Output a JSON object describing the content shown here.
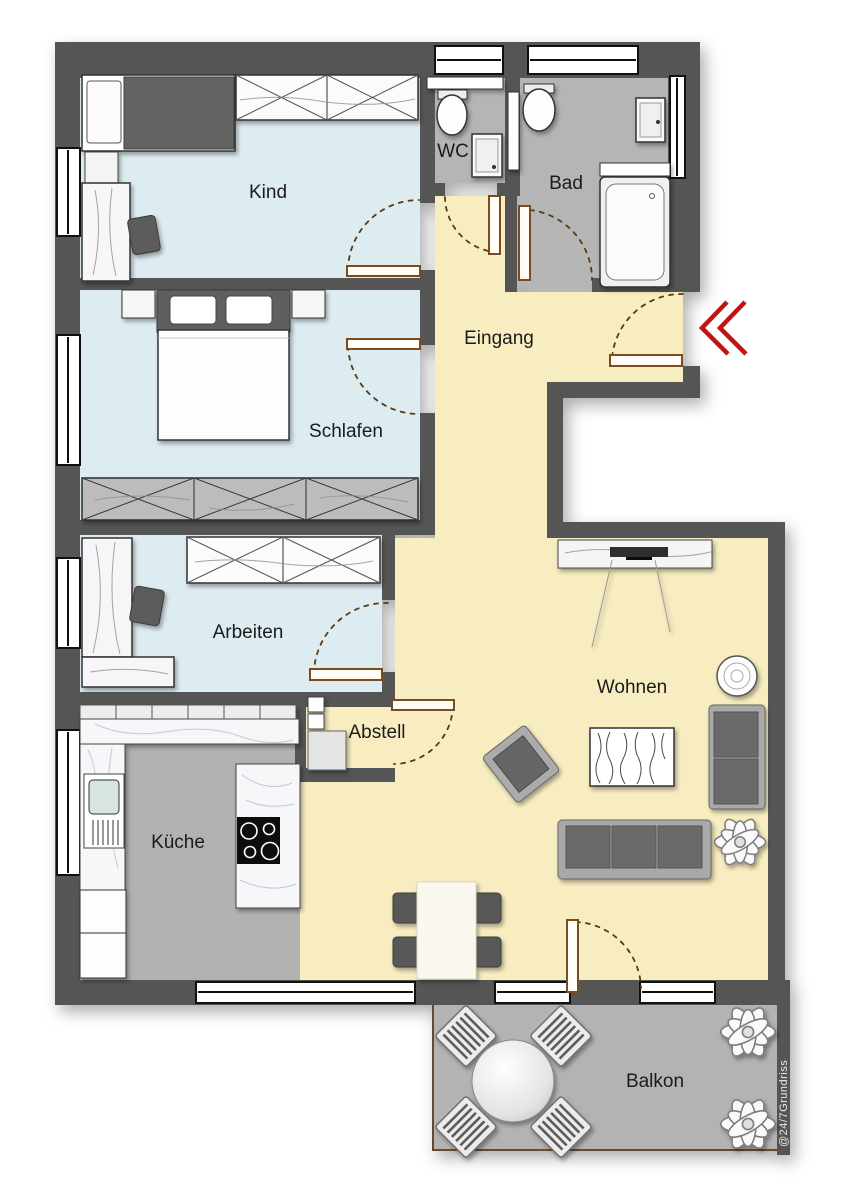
{
  "rooms": {
    "kind": {
      "label": "Kind"
    },
    "schlafen": {
      "label": "Schlafen"
    },
    "wc": {
      "label": "WC"
    },
    "bad": {
      "label": "Bad"
    },
    "eingang": {
      "label": "Eingang"
    },
    "arbeiten": {
      "label": "Arbeiten"
    },
    "abstell": {
      "label": "Abstell"
    },
    "kueche": {
      "label": "Küche"
    },
    "wohnen": {
      "label": "Wohnen"
    },
    "balkon": {
      "label": "Balkon"
    }
  },
  "watermark": {
    "text": "@24/7Grundriss"
  },
  "colors": {
    "wall": "#545454",
    "room_blue": "#dcecf1",
    "hall_yellow": "#f8edc0",
    "wet_gray": "#b5b5b5",
    "kitchen_gray": "#b2b2b2",
    "balcony_gray": "#b3b3b3",
    "door_frame_brown": "#7a4a20",
    "door_arc_brown": "#5b3a12",
    "entry_arrow_red": "#c11414"
  }
}
